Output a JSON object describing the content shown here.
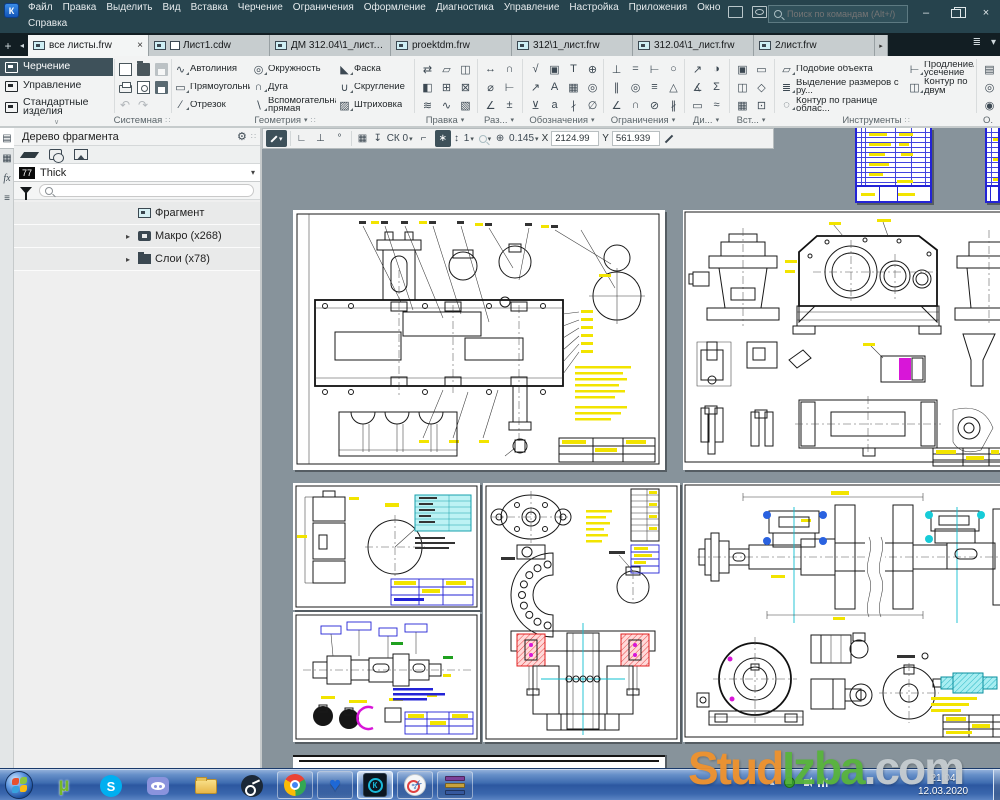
{
  "colors": {
    "titlebar_bg": "#26434d",
    "tabbar_bg": "#121e23",
    "ribbon_bg": "#f2f3f3",
    "accent_dark": "#3e515a",
    "canvas_bg": "#87939b",
    "taskbar_blue": "#3e6cb0",
    "highlight_yellow": "#f2e400",
    "drawing_blue": "#2323d6",
    "drawing_cyan": "#10c0d2",
    "drawing_magenta": "#d816d8",
    "drawing_red": "#e02020",
    "watermark_orange": "#f0922d",
    "watermark_green": "#58b43c",
    "watermark_gray": "#c6ccd0"
  },
  "icons": {
    "logo": "К",
    "minimize": "–",
    "close": "×",
    "tab_add": "+",
    "tab_scroll": "◂",
    "tab_more": "▸",
    "tab_list": "≣",
    "caret": "▾",
    "handle": "∷",
    "collapse": "∨",
    "undo": "↶",
    "redo": "↷",
    "gear": "⚙",
    "branch": "▸",
    "fx": "fx",
    "strip_tree": "▤",
    "strip_props": "▦",
    "strip_menu": "≡",
    "pb_snap1": "∟",
    "pb_snap2": "⊥",
    "pb_snap3": "°",
    "pb_grid": "▦",
    "pb_cs": "↧",
    "pb_corner": "⌐",
    "pb_round": "∗",
    "pb_step": "↕",
    "pb_zoom": "⊕",
    "tray_up": "▴",
    "heart": "♥",
    "scissors": "✂",
    "utorrent": "µ",
    "skype": "S",
    "kompas": "К"
  },
  "titlebar": {
    "menu": [
      "Файл",
      "Правка",
      "Выделить",
      "Вид",
      "Вставка",
      "Черчение",
      "Ограничения",
      "Оформление",
      "Диагностика",
      "Управление",
      "Настройка",
      "Приложения",
      "Окно"
    ],
    "menu2": "Справка",
    "search_placeholder": "Поиск по командам (Alt+/)"
  },
  "tabs": [
    {
      "label": "все листы.frw",
      "active": true
    },
    {
      "label": "Лист1.cdw",
      "extra_icon": true
    },
    {
      "label": "ДМ 312.04\\1_лист.frw"
    },
    {
      "label": "proektdm.frw"
    },
    {
      "label": "312\\1_лист.frw"
    },
    {
      "label": "312.04\\1_лист.frw"
    },
    {
      "label": "2лист.frw"
    }
  ],
  "categories": [
    {
      "label": "Черчение",
      "active": true
    },
    {
      "label": "Управление"
    },
    {
      "label": "Стандартные изделия"
    }
  ],
  "ribbon": {
    "system_label": "Системная",
    "geometry": {
      "label": "Геометрия",
      "tools": [
        {
          "label": "Автолиния",
          "glyph": "∿"
        },
        {
          "label": "Прямоугольник",
          "glyph": "▭"
        },
        {
          "label": "Отрезок",
          "glyph": "∕"
        },
        {
          "label": "Окружность",
          "glyph": "◎"
        },
        {
          "label": "Дуга",
          "glyph": "∩"
        },
        {
          "label": "Вспомогательная прямая",
          "glyph": "∖"
        },
        {
          "label": "Фаска",
          "glyph": "◣"
        },
        {
          "label": "Скругление",
          "glyph": "∪"
        },
        {
          "label": "Штриховка",
          "glyph": "▨"
        }
      ]
    },
    "grids": [
      {
        "label": "Правка",
        "icons": [
          "⇄",
          "◧",
          "≋",
          "▱",
          "⊞",
          "∿",
          "◫",
          "⊠",
          "▧"
        ]
      },
      {
        "label": "Раз...",
        "icons": [
          "↔",
          "⌀",
          "∠",
          "∩",
          "⊢",
          "±"
        ]
      },
      {
        "label": "Обозначения",
        "icons": [
          "√",
          "↗",
          "⊻",
          "▣",
          "А",
          "а",
          "Т",
          "▦",
          "∤",
          "⊕",
          "◎",
          "∅"
        ]
      },
      {
        "label": "Ограничения",
        "icons": [
          "⊥",
          "∥",
          "∠",
          "=",
          "◎",
          "∩",
          "⊢",
          "≡",
          "⊘",
          "○",
          "△",
          "∦"
        ]
      },
      {
        "label": "Ди...",
        "icons": [
          "↗",
          "∡",
          "▭",
          "◑",
          "Σ",
          "≈"
        ]
      },
      {
        "label": "Вст...",
        "icons": [
          "▣",
          "◫",
          "▦",
          "▭",
          "◇",
          "⊡"
        ]
      }
    ],
    "instruments": {
      "label": "Инструменты",
      "tools": [
        {
          "label": "Подобие объекта",
          "glyph": "▱"
        },
        {
          "label": "Выделение размеров с ру...",
          "glyph": "≣"
        },
        {
          "label": "Контур по границе облас...",
          "glyph": "◌"
        },
        {
          "label": "Продление/усечение",
          "glyph": "⊢"
        },
        {
          "label": "Контур по двум контурам",
          "glyph": "◫"
        }
      ]
    },
    "o_label": "О.",
    "o_icons": [
      "▤",
      "◎",
      "◉"
    ]
  },
  "parambar": {
    "cs": "СК 0",
    "step": "1",
    "zoom": "0.145",
    "x_label": "X",
    "x": "2124.99",
    "y_label": "Y",
    "y": "561.939"
  },
  "panel": {
    "title": "Дерево фрагмента",
    "badge": "77",
    "style": "Thick",
    "tree": [
      {
        "label": "Фрагмент",
        "icon": "fragment"
      },
      {
        "label": "Макро (x268)",
        "icon": "macro",
        "arrow": true
      },
      {
        "label": "Слои (x78)",
        "icon": "layers",
        "arrow": true
      }
    ]
  },
  "taskbar": {
    "time": "21:04",
    "date": "12.03.2020"
  },
  "watermark": {
    "p1": "Stud",
    "p2": "Izba",
    "p3": ".com"
  }
}
